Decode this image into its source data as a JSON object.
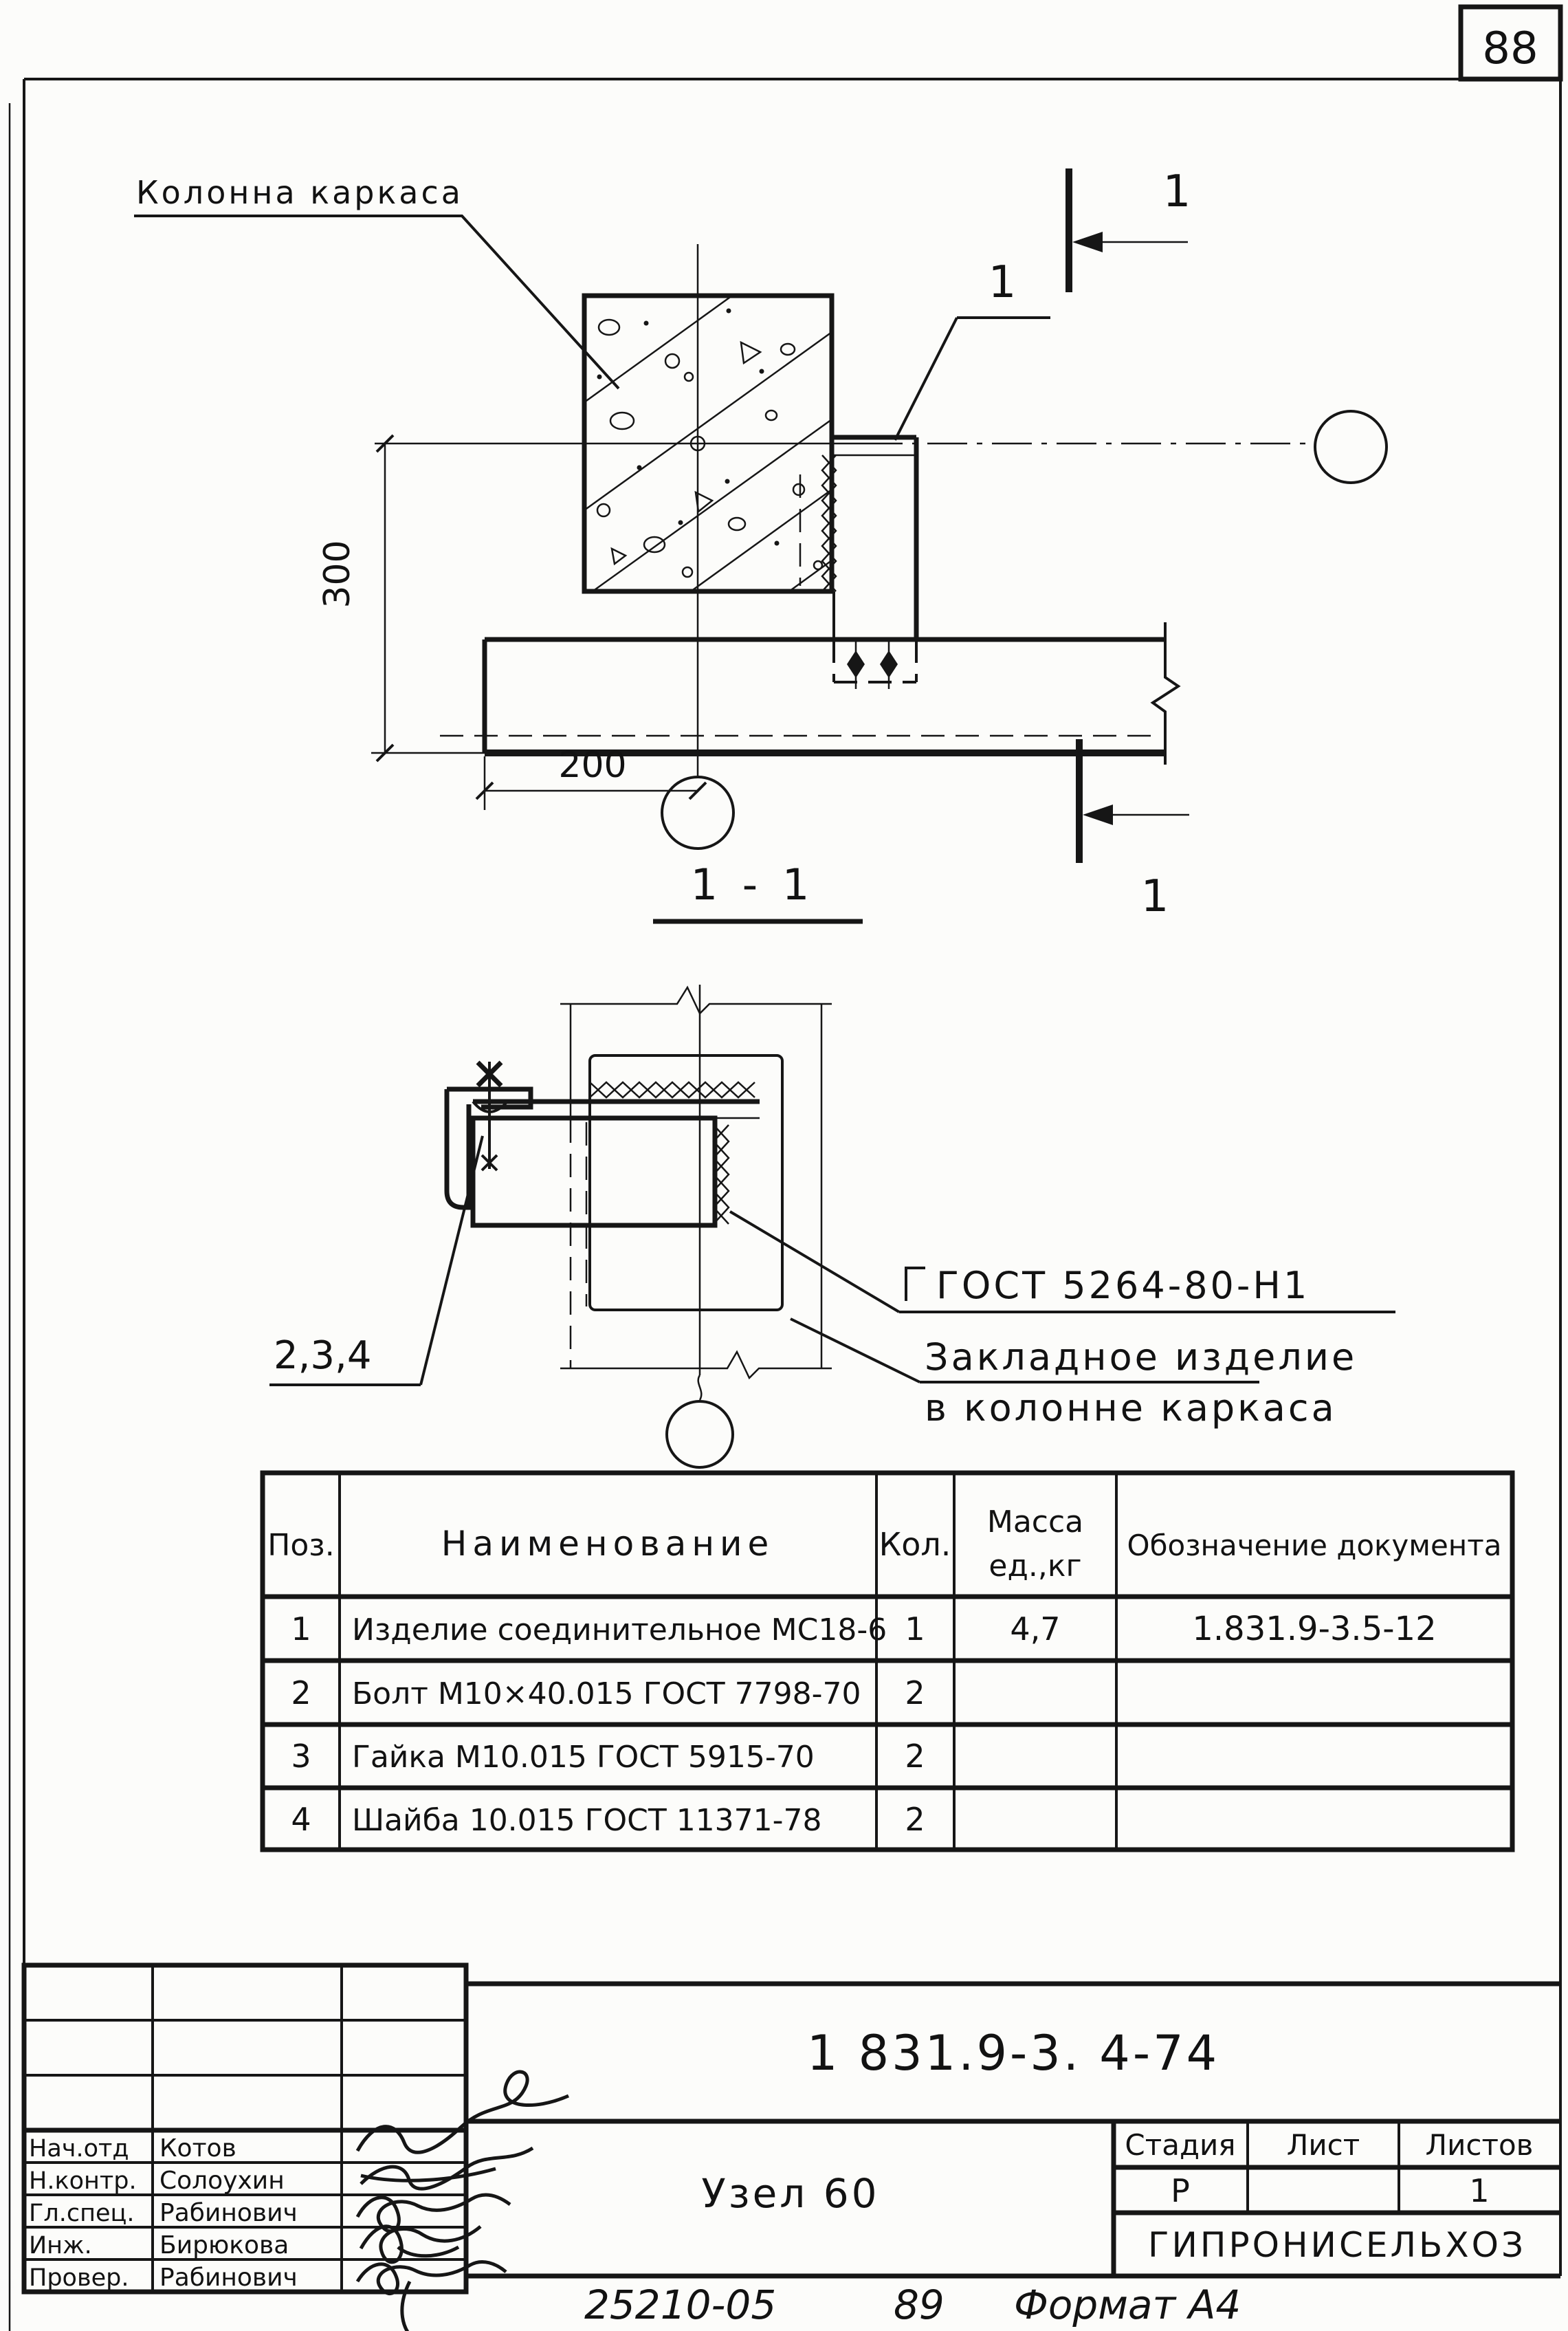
{
  "page": {
    "number": "88",
    "stamp_code": "25210-05",
    "stamp_year": "89",
    "stamp_format": "Формат А4"
  },
  "plan_view": {
    "column_label": "Колонна каркаса",
    "dim_vertical": "300",
    "dim_horizontal": "200",
    "section_mark_top": "1",
    "section_mark_bottom": "1",
    "item_callout": "1"
  },
  "section_view": {
    "title": "1 - 1",
    "items_callout": "2,3,4",
    "weld_note": "ГОСТ 5264-80-Н1",
    "embed_note_line1": "Закладное изделие",
    "embed_note_line2": "в колонне каркаса"
  },
  "parts_table": {
    "headers": {
      "pos": "Поз.",
      "name": "Наименование",
      "qty": "Кол.",
      "mass_line1": "Масса",
      "mass_line2": "ед.,кг",
      "doc": "Обозначение документа"
    },
    "rows": [
      {
        "pos": "1",
        "name": "Изделие соединительное МС18-6",
        "qty": "1",
        "mass": "4,7",
        "doc": "1.831.9-3.5-12"
      },
      {
        "pos": "2",
        "name": "Болт М10×40.015 ГОСТ 7798-70",
        "qty": "2",
        "mass": "",
        "doc": ""
      },
      {
        "pos": "3",
        "name": "Гайка М10.015 ГОСТ 5915-70",
        "qty": "2",
        "mass": "",
        "doc": ""
      },
      {
        "pos": "4",
        "name": "Шайба 10.015 ГОСТ 11371-78",
        "qty": "2",
        "mass": "",
        "doc": ""
      }
    ]
  },
  "title_block": {
    "doc_number": "1 831.9-3. 4-74",
    "node_title": "Узел 60",
    "stage_label": "Стадия",
    "sheet_label": "Лист",
    "sheets_label": "Листов",
    "stage_value": "Р",
    "sheet_value": "",
    "sheets_value": "1",
    "organization": "ГИПРОНИСЕЛЬХОЗ",
    "signatures": [
      {
        "role": "Нач.отд",
        "name": "Котов"
      },
      {
        "role": "Н.контр.",
        "name": "Солоухин"
      },
      {
        "role": "Гл.спец.",
        "name": "Рабинович"
      },
      {
        "role": "Инж.",
        "name": "Бирюкова"
      },
      {
        "role": "Провер.",
        "name": "Рабинович"
      }
    ]
  }
}
